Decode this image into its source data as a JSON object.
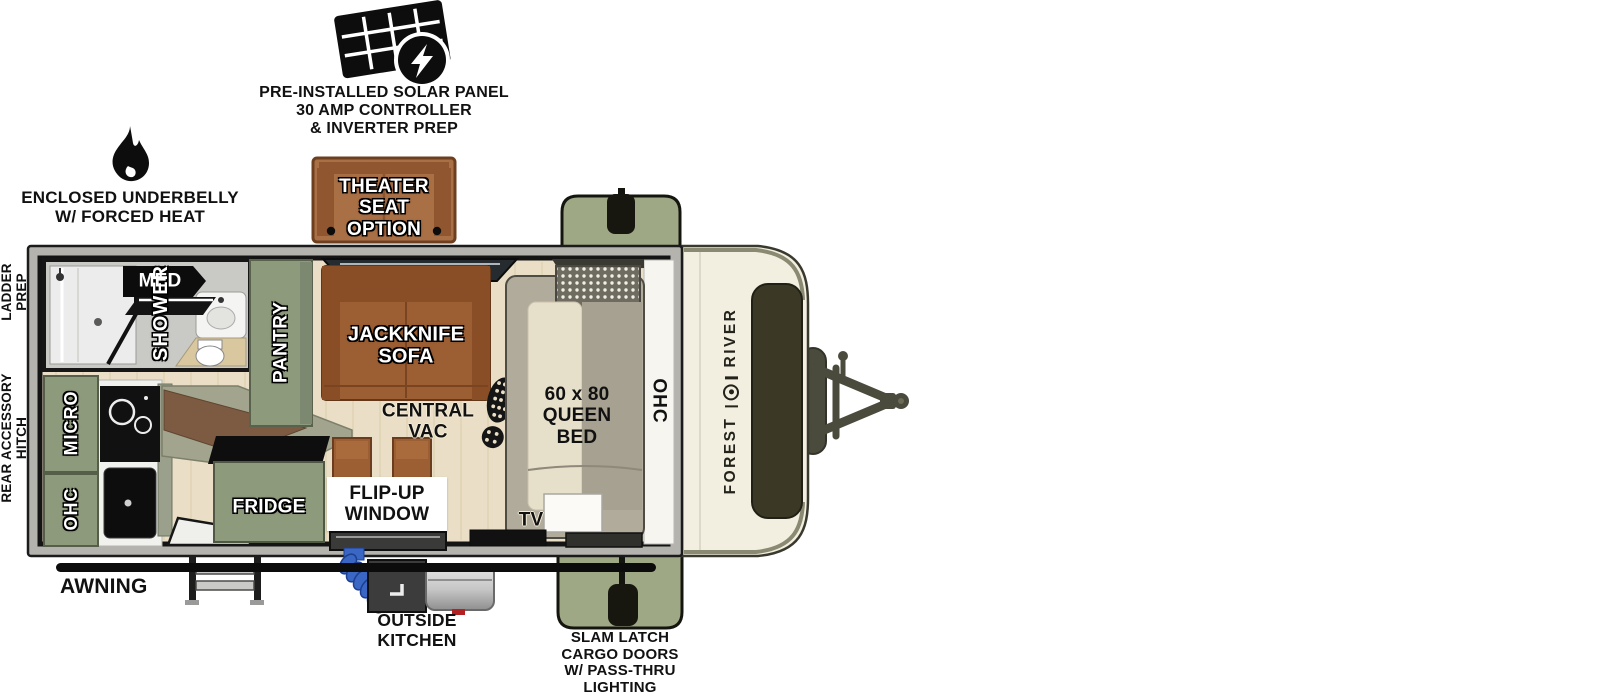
{
  "title": "Travel trailer floorplan diagram",
  "callouts": {
    "solar": "PRE-INSTALLED SOLAR PANEL\n30 AMP CONTROLLER\n& INVERTER PREP",
    "underbelly": "ENCLOSED UNDERBELLY\nW/ FORCED HEAT",
    "theater": "THEATER\nSEAT OPTION",
    "ladder_prep": "LADDER\nPREP",
    "rear_hitch": "REAR ACCESSORY\nHITCH",
    "awning": "AWNING",
    "outside_kitchen": "OUTSIDE\nKITCHEN",
    "cargo_doors": "SLAM LATCH\nCARGO DOORS\nW/ PASS-THRU\nLIGHTING"
  },
  "rooms": {
    "shower": "SHOWER",
    "med": "MED",
    "pantry": "PANTRY",
    "sofa": "JACKKNIFE\nSOFA",
    "central_vac": "CENTRAL\nVAC",
    "bed": "60 x 80\nQUEEN\nBED",
    "ohc_front": "OHC",
    "micro": "MICRO",
    "ohc_rear": "OHC",
    "fridge": "FRIDGE",
    "flip_window": "FLIP-UP\nWINDOW",
    "tv": "TV"
  },
  "brand": {
    "word1": "FOREST",
    "word2": "RIVER"
  },
  "icons": [
    "solar-panel-icon",
    "flame-icon",
    "boot-print-icon",
    "forest-river-emblem",
    "hitch-graphic",
    "entry-steps-graphic",
    "awning-bar-graphic",
    "cargo-door-graphic",
    "outside-kitchen-graphic"
  ],
  "colors": {
    "cabinet_green": "#8E9A7C",
    "cargo_green": "#9FA884",
    "floor_wood": "#EADFC6",
    "sofa_brown": "#9C5E33",
    "theater_brown": "#A96F45",
    "front_cap_cream": "#F2EFE1",
    "hitch_olive": "#4B4B3D",
    "wall_gray": "#B5B3AE",
    "counter_olive": "#A3A48E",
    "wood_edge_brown": "#7D5B42",
    "bed_blanket": "#A7A191",
    "bed_pillow": "#E6DFC9",
    "hose_blue": "#3A66C4",
    "ink": "#111111"
  }
}
